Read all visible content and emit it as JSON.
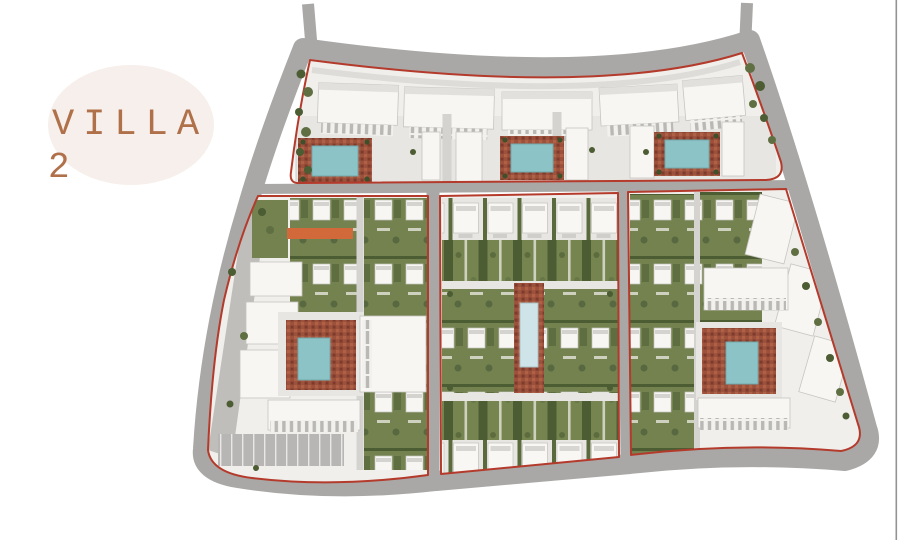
{
  "page": {
    "background_color": "#ffffff",
    "right_border_color": "#939393"
  },
  "badge": {
    "line1": "VILLA",
    "line2": "2",
    "bg_color": "#f7efeb",
    "text_color": "#b0714a"
  },
  "site_plan": {
    "type": "master-plan-rendering",
    "boundary_color": "#b43a2c",
    "road_color": "#a9a8a6",
    "block_base_color": "#f0efeb",
    "building_color": "#f7f6f3",
    "garden_green": "#73824e",
    "hedge_green": "#4d5d33",
    "pool_teal": "#8cc3c6",
    "pool_pale": "#cfe4e8",
    "deck_terracotta": "#9c513c",
    "accent_orange": "#d2693b",
    "parking_gray": "#b7b6b4",
    "blocks": [
      {
        "id": "north-band",
        "pools": 3,
        "features": [
          "apartment-slabs",
          "three-pool-courtyards"
        ]
      },
      {
        "id": "west-block",
        "pools": 1,
        "features": [
          "townhouse-rows",
          "pool-courtyard",
          "parking",
          "orange-building"
        ]
      },
      {
        "id": "central-block",
        "pools": 1,
        "features": [
          "villa-rows",
          "garden-strips",
          "linear-pool-spine"
        ]
      },
      {
        "id": "east-block",
        "pools": 1,
        "features": [
          "townhouse-rows",
          "pool-courtyard",
          "edge-slabs"
        ]
      }
    ]
  }
}
